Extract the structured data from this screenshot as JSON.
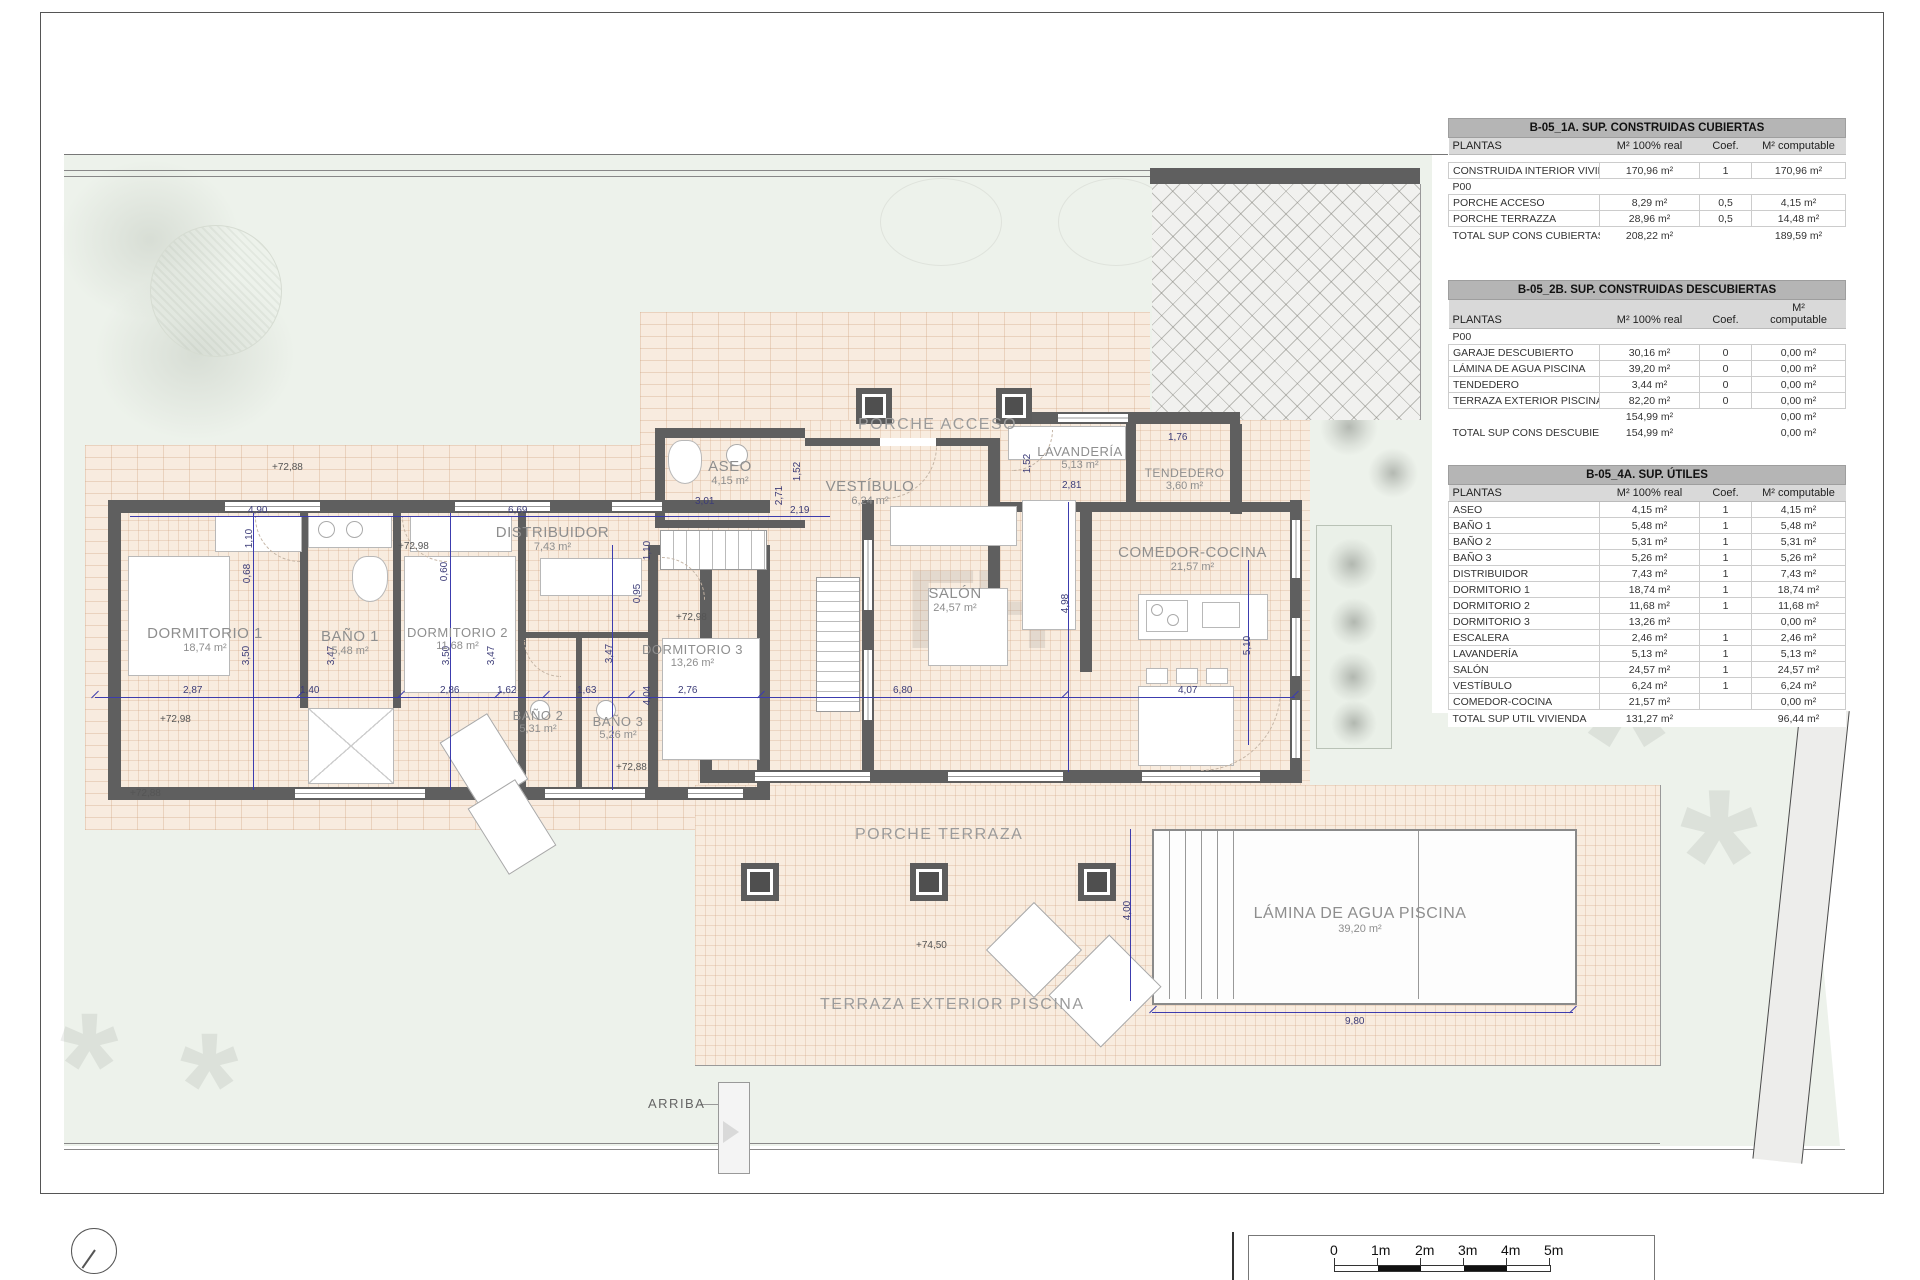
{
  "plan": {
    "rooms": [
      {
        "name": "DORMITORIO 1",
        "area": "18,74 m²"
      },
      {
        "name": "BAÑO 1",
        "area": "5,48 m²"
      },
      {
        "name": "DORMITORIO 2",
        "area": "11,68 m²"
      },
      {
        "name": "DISTRIBUIDOR",
        "area": "7,43 m²"
      },
      {
        "name": "BAÑO 2",
        "area": "5,31 m²"
      },
      {
        "name": "BAÑO 3",
        "area": "5,26 m²"
      },
      {
        "name": "DORMITORIO 3",
        "area": "13,26 m²"
      },
      {
        "name": "ASEO",
        "area": "4,15 m²"
      },
      {
        "name": "VESTÍBULO",
        "area": "6,24 m²"
      },
      {
        "name": "LAVANDERÍA",
        "area": "5,13 m²"
      },
      {
        "name": "TENDEDERO",
        "area": "3,60 m²"
      },
      {
        "name": "SALÓN",
        "area": "24,57 m²"
      },
      {
        "name": "COMEDOR-COCINA",
        "area": "21,57 m²"
      }
    ],
    "zones": {
      "porche_acceso": "PORCHE ACCESO",
      "porche_terraza": "PORCHE TERRAZA",
      "terraza_exterior": "TERRAZA EXTERIOR PISCINA",
      "arriba": "ARRIBA"
    },
    "pool": {
      "name": "LÁMINA DE AGUA PISCINA",
      "area": "39,20 m²"
    },
    "levels": [
      "+72,88",
      "+72,98",
      "+72,98",
      "+72,98",
      "+72,88",
      "+72,88",
      "+74,50"
    ],
    "dims": [
      "2,87",
      "1,40",
      "2,86",
      "1,62",
      "1,63",
      "2,76",
      "6,80",
      "4,07",
      "3,50",
      "3,47",
      "3,50",
      "3,47",
      "3,47",
      "4,04",
      "1,10",
      "0,95",
      "0,68",
      "0,60",
      "1,10",
      "4,90",
      "6,69",
      "2,19",
      "3,01",
      "2,71",
      "1,52",
      "2,81",
      "1,52",
      "1,76",
      "4,98",
      "5,10",
      "9,80",
      "4,00"
    ],
    "watermark": "EH"
  },
  "tables": [
    {
      "title": "B-05_1A. SUP. CONSTRUIDAS CUBIERTAS",
      "columns": [
        "PLANTAS",
        "M² 100% real",
        "Coef.",
        "M² computable"
      ],
      "gap": true,
      "rows": [
        {
          "cells": [
            "CONSTRUIDA INTERIOR VIVIENDA",
            "170,96 m²",
            "1",
            "170,96 m²"
          ]
        },
        {
          "cells": [
            "P00",
            "",
            "",
            ""
          ],
          "cls": "group"
        },
        {
          "cells": [
            "PORCHE ACCESO",
            "8,29 m²",
            "0,5",
            "4,15 m²"
          ]
        },
        {
          "cells": [
            "PORCHE TERRAZZA",
            "28,96 m²",
            "0,5",
            "14,48 m²"
          ]
        },
        {
          "cells": [
            "TOTAL SUP CONS CUBIERTAS",
            "208,22 m²",
            "",
            "189,59 m²"
          ],
          "cls": "total"
        }
      ]
    },
    {
      "title": "B-05_2B. SUP. CONSTRUIDAS DESCUBIERTAS",
      "columns": [
        "PLANTAS",
        "M² 100% real",
        "Coef.",
        "M²\ncomputable"
      ],
      "gap": false,
      "rows": [
        {
          "cells": [
            "P00",
            "",
            "",
            ""
          ],
          "cls": "group"
        },
        {
          "cells": [
            "GARAJE DESCUBIERTO",
            "30,16 m²",
            "0",
            "0,00 m²"
          ]
        },
        {
          "cells": [
            "LÁMINA DE AGUA PISCINA",
            "39,20 m²",
            "0",
            "0,00 m²"
          ]
        },
        {
          "cells": [
            "TENDEDERO",
            "3,44 m²",
            "0",
            "0,00 m²"
          ]
        },
        {
          "cells": [
            "TERRAZA EXTERIOR PISCINA",
            "82,20 m²",
            "0",
            "0,00 m²"
          ]
        },
        {
          "cells": [
            "",
            "154,99 m²",
            "",
            "0,00 m²"
          ],
          "cls": "subtotal"
        },
        {
          "cells": [
            "TOTAL SUP CONS DESCUBIERTAS",
            "154,99 m²",
            "",
            "0,00 m²"
          ],
          "cls": "total"
        }
      ]
    },
    {
      "title": "B-05_4A. SUP. ÚTILES",
      "columns": [
        "PLANTAS",
        "M² 100% real",
        "Coef.",
        "M² computable"
      ],
      "gap": false,
      "rows": [
        {
          "cells": [
            "ASEO",
            "4,15 m²",
            "1",
            "4,15 m²"
          ]
        },
        {
          "cells": [
            "BAÑO 1",
            "5,48 m²",
            "1",
            "5,48 m²"
          ]
        },
        {
          "cells": [
            "BAÑO 2",
            "5,31 m²",
            "1",
            "5,31 m²"
          ]
        },
        {
          "cells": [
            "BAÑO 3",
            "5,26 m²",
            "1",
            "5,26 m²"
          ]
        },
        {
          "cells": [
            "DISTRIBUIDOR",
            "7,43 m²",
            "1",
            "7,43 m²"
          ]
        },
        {
          "cells": [
            "DORMITORIO 1",
            "18,74 m²",
            "1",
            "18,74 m²"
          ]
        },
        {
          "cells": [
            "DORMITORIO 2",
            "11,68 m²",
            "1",
            "11,68 m²"
          ]
        },
        {
          "cells": [
            "DORMITORIO 3",
            "13,26 m²",
            "",
            "0,00 m²"
          ]
        },
        {
          "cells": [
            "ESCALERA",
            "2,46 m²",
            "1",
            "2,46 m²"
          ]
        },
        {
          "cells": [
            "LAVANDERÍA",
            "5,13 m²",
            "1",
            "5,13 m²"
          ]
        },
        {
          "cells": [
            "SALÓN",
            "24,57 m²",
            "1",
            "24,57 m²"
          ]
        },
        {
          "cells": [
            "VESTÍBULO",
            "6,24 m²",
            "1",
            "6,24 m²"
          ]
        },
        {
          "cells": [
            "COMEDOR-COCINA",
            "21,57 m²",
            "",
            "0,00 m²"
          ]
        },
        {
          "cells": [
            "TOTAL SUP UTIL VIVIENDA",
            "131,27 m²",
            "",
            "96,44 m²"
          ],
          "cls": "total"
        }
      ]
    }
  ],
  "scalebar": {
    "ticks": [
      "0",
      "1m",
      "2m",
      "3m",
      "4m",
      "5m"
    ]
  }
}
